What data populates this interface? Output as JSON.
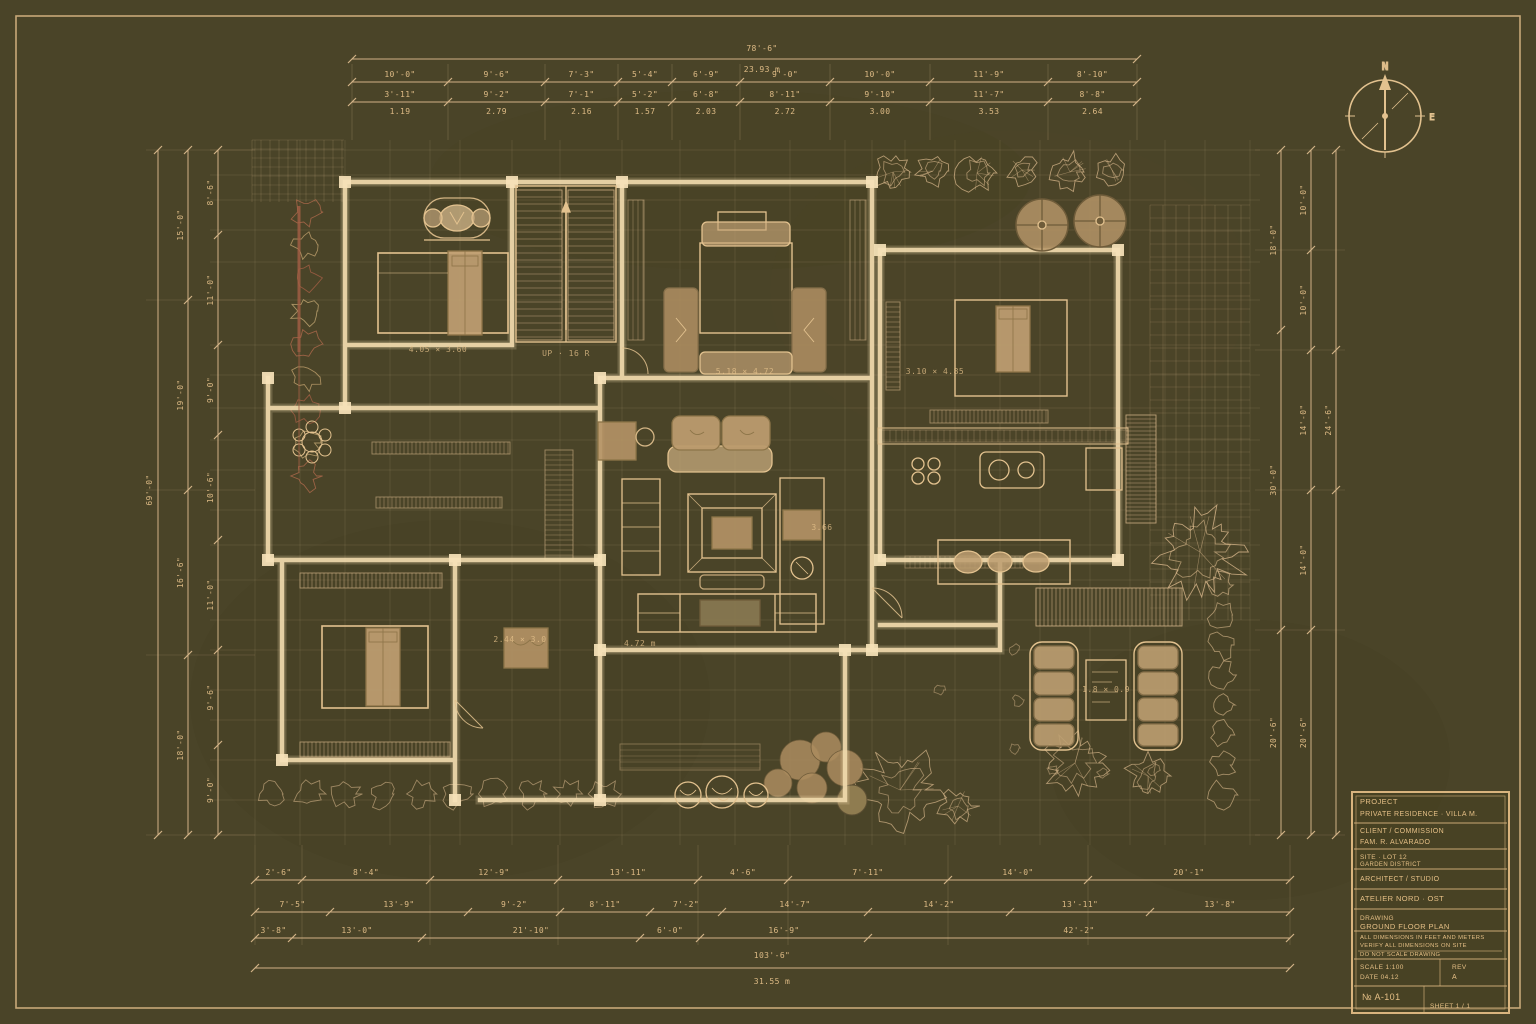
{
  "colors": {
    "background": "#4a4428",
    "line": "#d9b88c",
    "wall": "#f2dcae",
    "furniture": "#b89868",
    "mattress": "#c2a173",
    "accent_red": "#a55f45",
    "text": "#e9c48d",
    "border": "#c8a878"
  },
  "compass": {
    "north": "N",
    "east": "E"
  },
  "dims": {
    "top": {
      "overall": [
        "78'-6\"",
        "23.93 m"
      ],
      "row2": [
        "10'-0\"",
        "9'-6\"",
        "7'-3\"",
        "5'-4\"",
        "6'-9\"",
        "9'-0\"",
        "10'-0\"",
        "11'-9\"",
        "8'-10\""
      ],
      "row3_top": [
        "3'-11\"",
        "9'-2\"",
        "7'-1\"",
        "5'-2\"",
        "6'-8\"",
        "8'-11\"",
        "9'-10\"",
        "11'-7\"",
        "8'-8\""
      ],
      "row3_bot": [
        "1.19",
        "2.79",
        "2.16",
        "1.57",
        "2.03",
        "2.72",
        "3.00",
        "3.53",
        "2.64"
      ]
    },
    "bottom": {
      "rowA": [
        "2'-6\"",
        "8'-4\"",
        "12'-9\"",
        "13'-11\"",
        "4'-6\"",
        "7'-11\"",
        "14'-0\"",
        "20'-1\""
      ],
      "rowB": [
        "7'-5\"",
        "13'-9\"",
        "9'-2\"",
        "8'-11\"",
        "7'-2\"",
        "14'-7\"",
        "14'-2\"",
        "13'-11\"",
        "13'-8\""
      ],
      "rowC": [
        "3'-8\"",
        "13'-0\"",
        "21'-10\"",
        "6'-0\"",
        "16'-9\"",
        "42'-2\""
      ],
      "overall": [
        "103'-6\"",
        "31.55 m"
      ]
    },
    "left": {
      "overall": "69'-0\"",
      "col2": [
        "15'-0\"",
        "19'-0\"",
        "16'-6\"",
        "18'-0\""
      ],
      "col3": [
        "8'-6\"",
        "11'-0\"",
        "9'-0\"",
        "10'-6\"",
        "11'-0\"",
        "9'-6\"",
        "9'-0\""
      ]
    },
    "right": {
      "col1": [
        "18'-0\"",
        "30'-0\"",
        "20'-6\""
      ],
      "col2": [
        "10'-0\"",
        "10'-0\"",
        "14'-0\"",
        "14'-0\"",
        "20'-6\""
      ],
      "col3": "24'-6\""
    }
  },
  "plan_labels": [
    "4.05 × 3.60",
    "UP · 16 R",
    "5.18 × 4.72",
    "3.10 × 4.85",
    "4.72 m",
    "2.44 × 3.0",
    "1.8 × 0.9",
    "3.66"
  ],
  "title_block": {
    "rows": [
      {
        "lines": [
          "PROJECT",
          "PRIVATE RESIDENCE · VILLA M."
        ]
      },
      {
        "lines": [
          "CLIENT / COMMISSION",
          "FAM. R. ALVARADO"
        ]
      },
      {
        "lines": [
          "SITE · LOT 12",
          "GARDEN DISTRICT"
        ]
      },
      {
        "lines": [
          "ARCHITECT / STUDIO"
        ]
      },
      {
        "lines": [
          "ATELIER NORD · OST"
        ]
      },
      {
        "lines": [
          "DRAWING",
          "GROUND FLOOR PLAN"
        ]
      },
      {
        "lines": [
          "ALL DIMENSIONS IN FEET AND METERS",
          "VERIFY ALL DIMENSIONS ON SITE",
          "DO NOT SCALE DRAWING"
        ]
      },
      {
        "lines": [
          "SCALE 1:100",
          "DATE 04.12",
          "REV",
          "A"
        ]
      },
      {
        "lines": [
          "№ A-101",
          "SHEET 1 / 1"
        ]
      }
    ]
  }
}
